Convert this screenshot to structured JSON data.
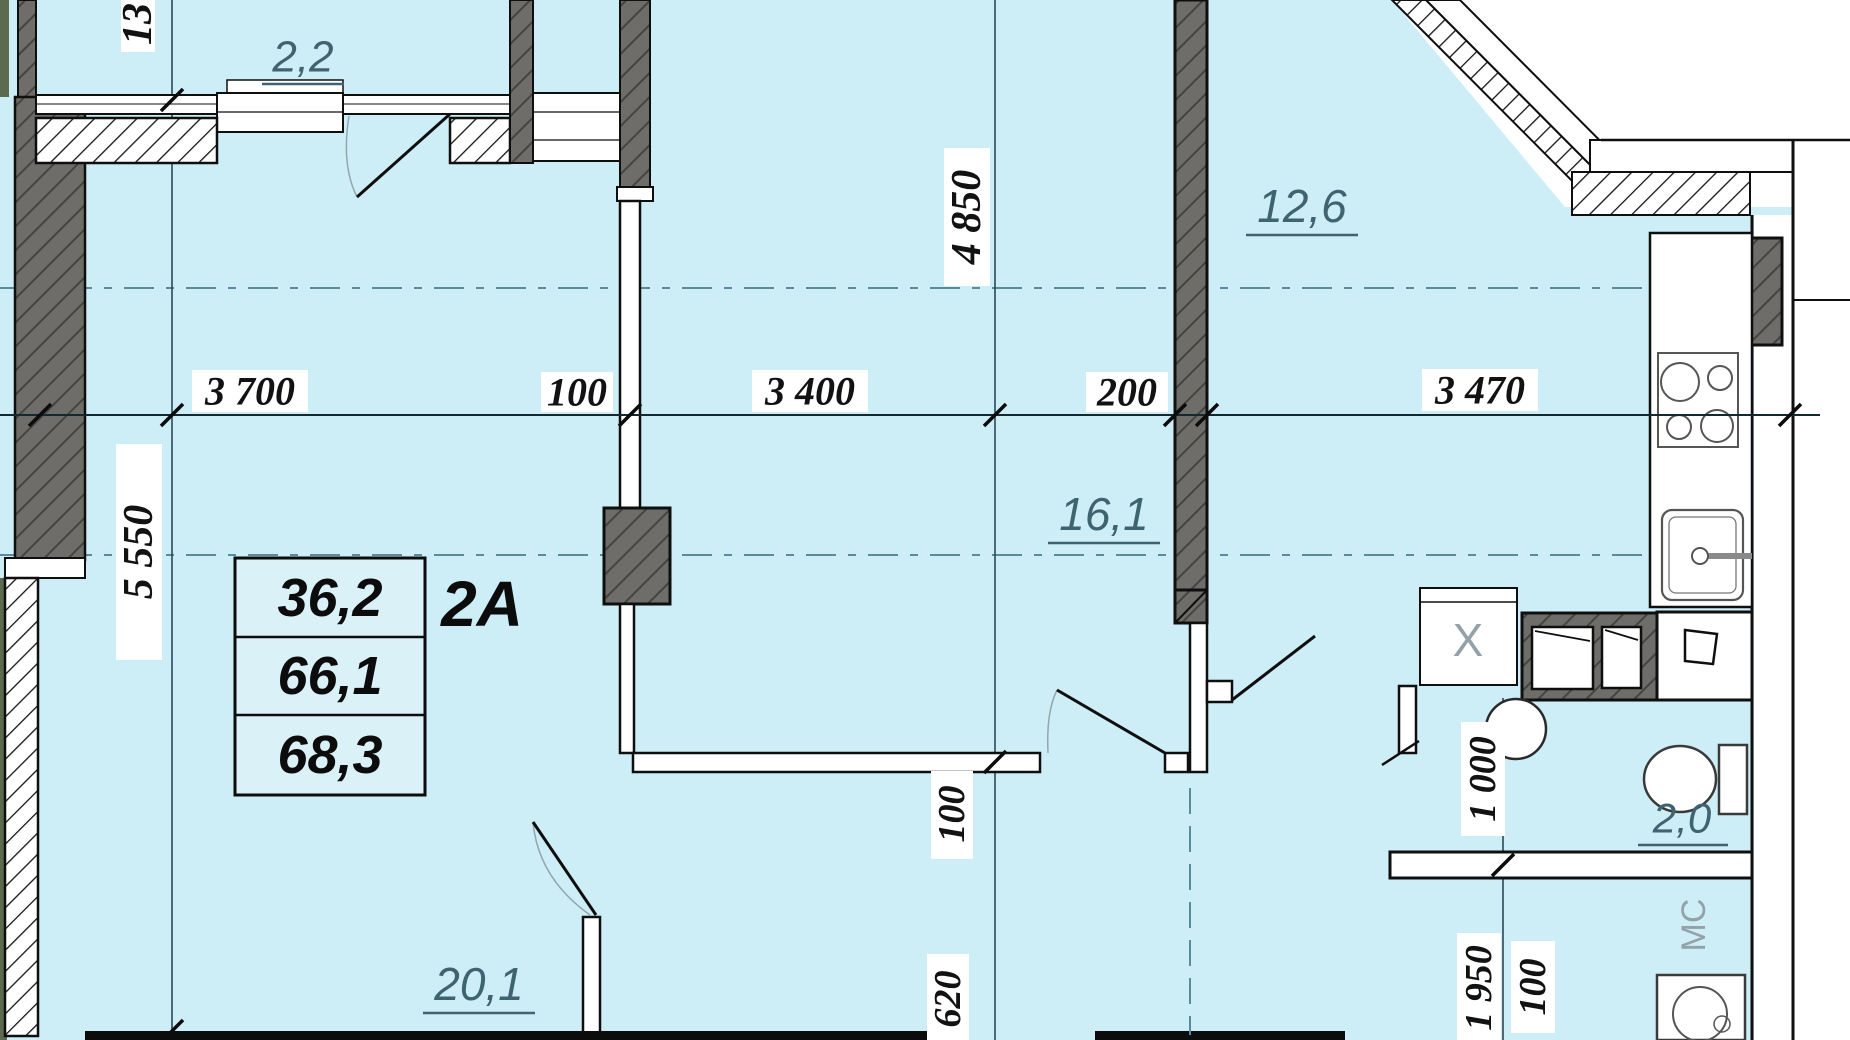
{
  "unit": {
    "code": "2A",
    "area_live": "36,2",
    "area_total": "66,1",
    "area_overall": "68,3"
  },
  "rooms": {
    "balcony": "2,2",
    "kitchen": "12,6",
    "bedroom": "16,1",
    "living": "20,1",
    "wc": "2,0"
  },
  "dims": {
    "h": {
      "d1": "3 700",
      "d2": "100",
      "d3": "3 400",
      "d4": "200",
      "d5": "3 470"
    },
    "v_left": {
      "top": "13",
      "main": "5 550"
    },
    "v_mid": {
      "top": "4 850",
      "wall": "100",
      "bottom": "620"
    },
    "v_right": {
      "wc": "1 000",
      "bath": "1 950",
      "wall": "100"
    }
  },
  "fixtures": {
    "washer": "МС",
    "boiler": "X"
  },
  "colors": {
    "background": "#cdeef6",
    "wall_dark": "#6e6d6a",
    "axis_dash": "#5b8b99",
    "room_label": "#3f6370",
    "outside": "#ffffff"
  }
}
